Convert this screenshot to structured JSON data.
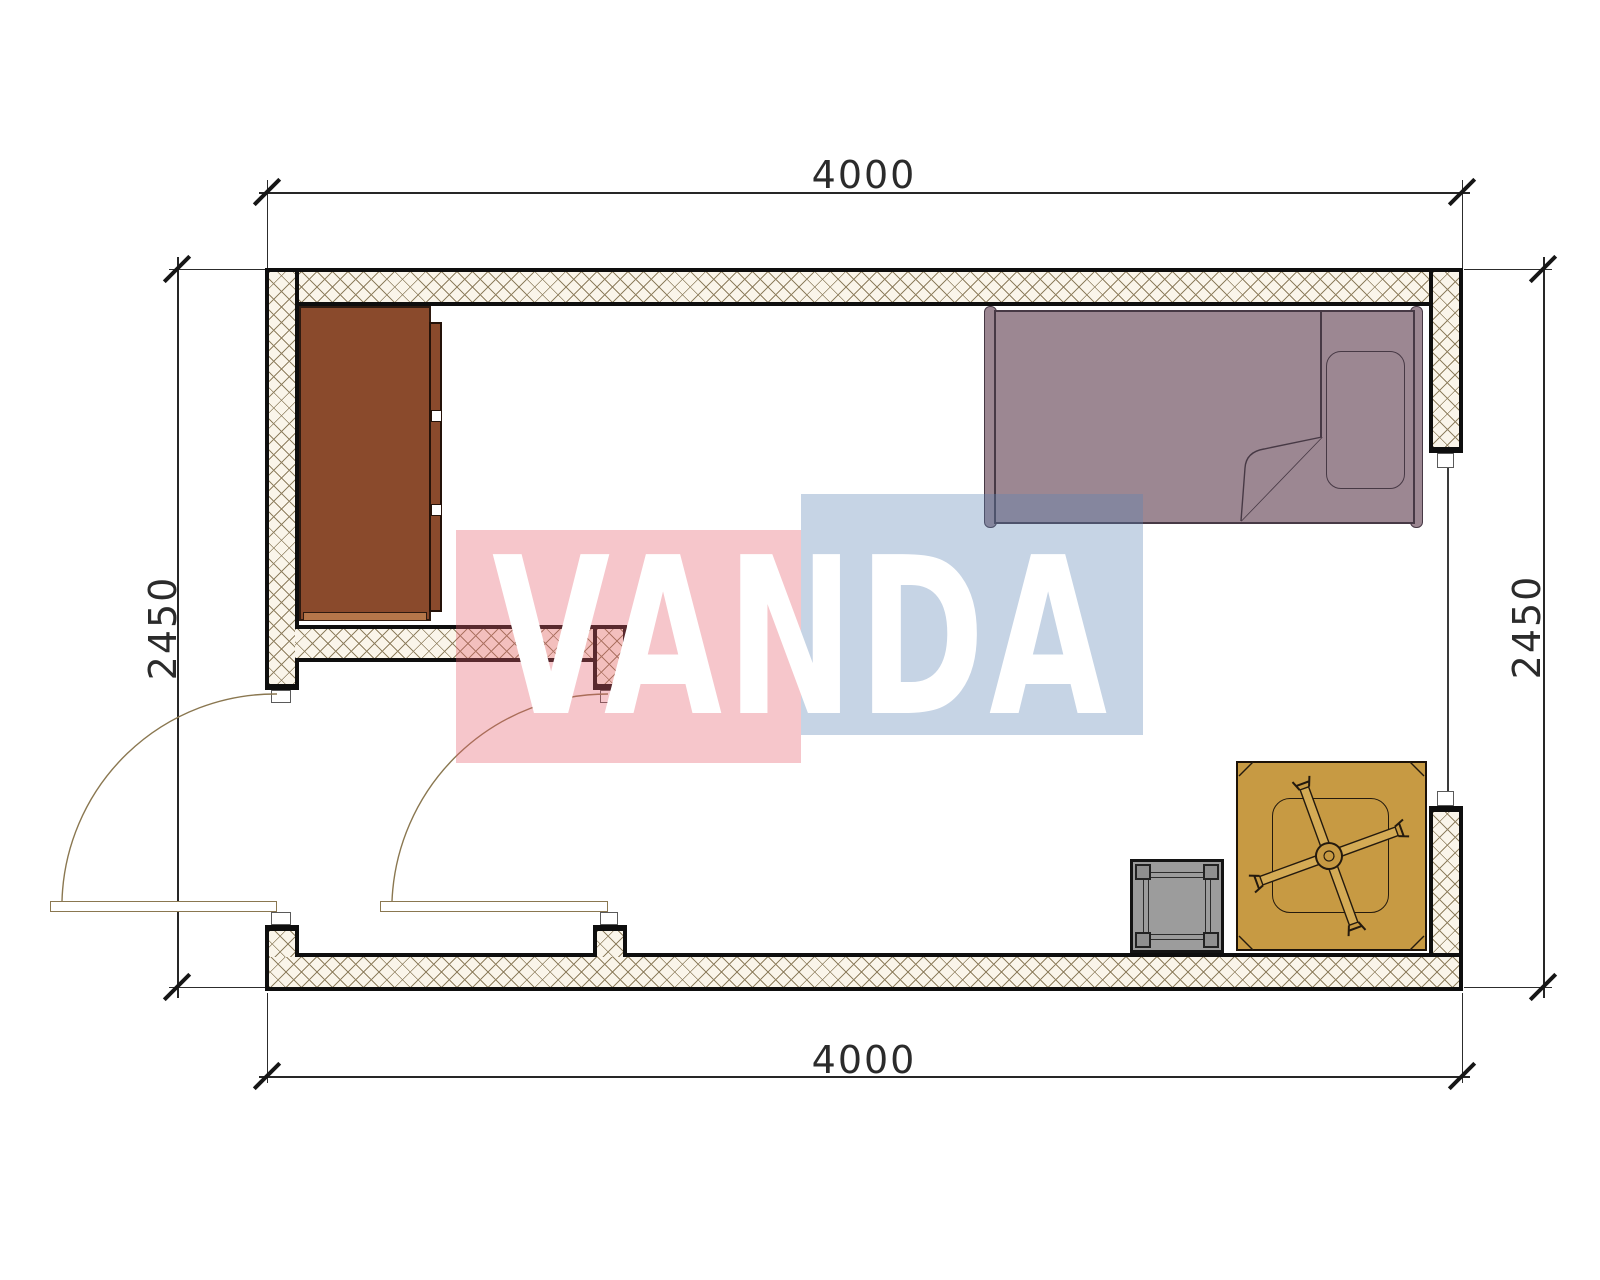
{
  "title": "Room floor plan drawing",
  "dims": {
    "top": "4000",
    "bottom": "4000",
    "left": "2450",
    "right": "2450"
  },
  "watermark": {
    "text": "VANDA",
    "red_block_color": "rgba(229,92,106,0.35)",
    "blue_block_color": "rgba(92,132,181,0.35)",
    "text_color": "#ffffff"
  },
  "room": {
    "width_mm": "4000",
    "depth_mm": "2450"
  },
  "colors": {
    "wall_fill": "#faf5ea",
    "wall_hatch_line": "#8f8060",
    "wall_border": "#0e0e0e",
    "dresser": "#8a4a2c",
    "dresser_edge": "#b5764a",
    "bed": "#9c8792",
    "bed_outline": "#473945",
    "floor_mat": "#c79a43",
    "fan_blade": "#d4ab55",
    "side_table": "#9c9c9c",
    "door_line": "#8a7750",
    "dimension_line": "#262626"
  },
  "furniture": [
    {
      "name": "dresser"
    },
    {
      "name": "single-bed"
    },
    {
      "name": "pillow"
    },
    {
      "name": "floor-mat"
    },
    {
      "name": "ceiling-fan"
    },
    {
      "name": "side-table"
    }
  ],
  "openings": [
    {
      "name": "entry-door"
    },
    {
      "name": "interior-door"
    },
    {
      "name": "window"
    }
  ]
}
